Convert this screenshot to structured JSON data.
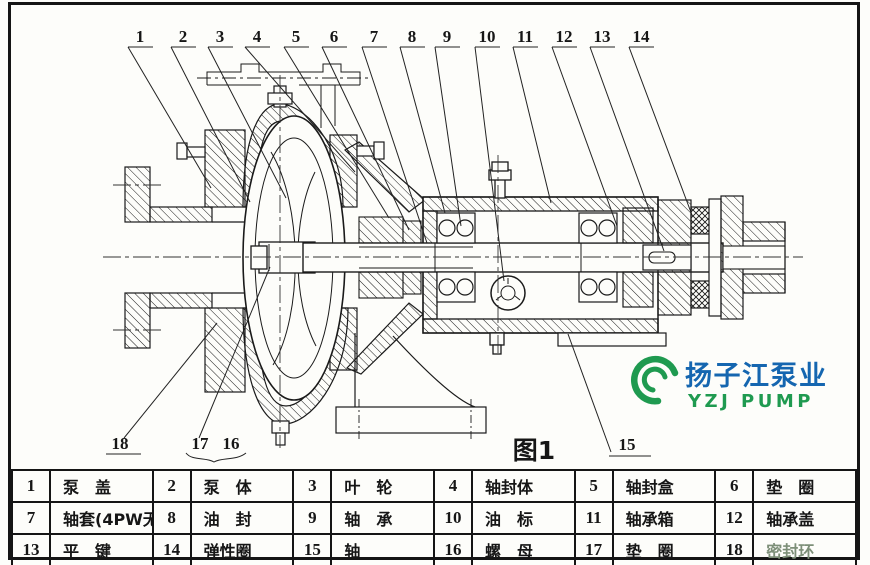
{
  "figure_label": "图1",
  "logo": {
    "name_cn": "扬子江泵业",
    "name_en": "YZJ PUMP",
    "green": "#1f9a50",
    "blue": "#1566b0"
  },
  "callouts": {
    "top": [
      "1",
      "2",
      "3",
      "4",
      "5",
      "6",
      "7",
      "8",
      "9",
      "10",
      "11",
      "12",
      "13",
      "14"
    ],
    "bottom": [
      "18",
      "17",
      "16",
      "15"
    ]
  },
  "parts": {
    "rows": [
      [
        {
          "no": "1",
          "name": "泵　盖"
        },
        {
          "no": "2",
          "name": "泵　体"
        },
        {
          "no": "3",
          "name": "叶　轮"
        },
        {
          "no": "4",
          "name": "轴封体"
        },
        {
          "no": "5",
          "name": "轴封盒"
        },
        {
          "no": "6",
          "name": "垫　圈"
        }
      ],
      [
        {
          "no": "7",
          "name": "轴套(4PW无)"
        },
        {
          "no": "8",
          "name": "油　封"
        },
        {
          "no": "9",
          "name": "轴　承"
        },
        {
          "no": "10",
          "name": "油　标"
        },
        {
          "no": "11",
          "name": "轴承箱"
        },
        {
          "no": "12",
          "name": "轴承盖"
        }
      ],
      [
        {
          "no": "13",
          "name": "平　键"
        },
        {
          "no": "14",
          "name": "弹性圈"
        },
        {
          "no": "15",
          "name": "轴"
        },
        {
          "no": "16",
          "name": "螺　母"
        },
        {
          "no": "17",
          "name": "垫　圈"
        },
        {
          "no": "18",
          "name": "密封环"
        }
      ]
    ]
  }
}
